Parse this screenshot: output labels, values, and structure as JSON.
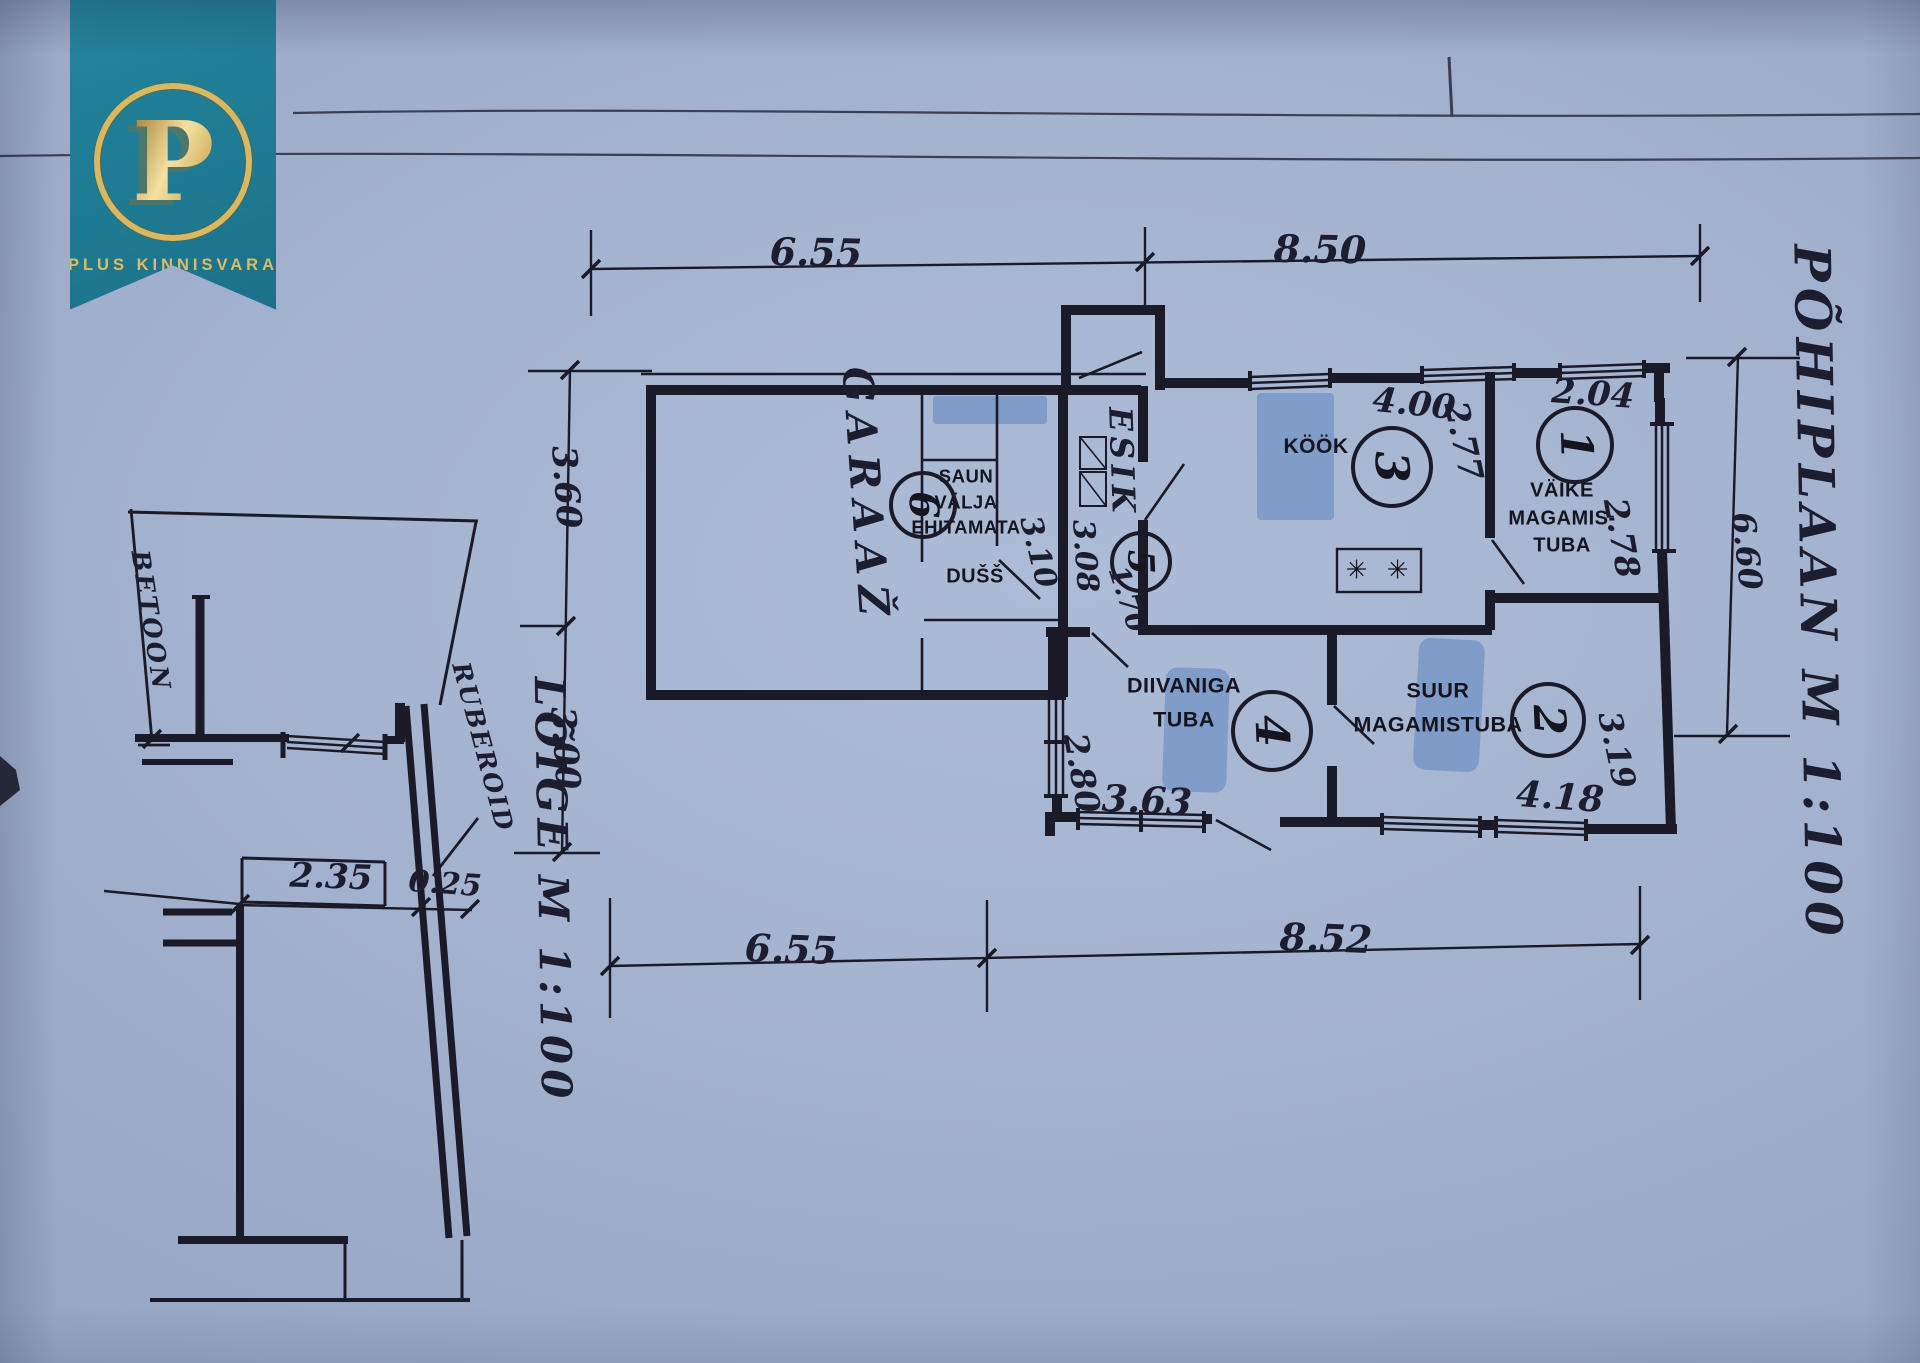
{
  "brand": {
    "name": "PLUS KINNISVARA",
    "monogram": "P",
    "banner_color": "#1e7a92",
    "gold_color": "#d8b860"
  },
  "plan": {
    "title": "PÕHIPLAAN M 1:100",
    "rooms": {
      "garage": "GARAAŽ",
      "hall": "ESIK",
      "kitchen": "KÖÖK",
      "shower": "DUŠŠ",
      "sauna_line1": "SAUN",
      "sauna_line2": "VÄLJA",
      "sauna_line3": "EHITAMATA",
      "small_bedroom_line1": "VÄIKE",
      "small_bedroom_line2": "MAGAMIS-",
      "small_bedroom_line3": "TUBA",
      "living_line1": "DIIVANIGA",
      "living_line2": "TUBA",
      "big_bedroom_line1": "SUUR",
      "big_bedroom_line2": "MAGAMISTUBA"
    },
    "room_numbers": {
      "r1": "1",
      "r2": "2",
      "r3": "3",
      "r4": "4",
      "r5": "5",
      "r6": "6"
    },
    "dims": {
      "top_left": "6.55",
      "top_right": "8.50",
      "bottom_left": "6.55",
      "bottom_right": "8.52",
      "left_upper": "3.60",
      "left_lower": "3.00",
      "right_side": "6.60",
      "hall_a": "3.10",
      "hall_b": "3.08",
      "hall_c": "1.70",
      "kitchen_w": "4.00",
      "kitchen_h": "2.77",
      "bed1_w": "2.04",
      "bed1_h": "2.78",
      "living_h": "2.80",
      "living_w": "3.63",
      "bed2_h": "3.19",
      "bed2_w": "4.18"
    },
    "stove_symbol": "✳ ✳"
  },
  "section": {
    "title": "LÕIGE M 1:100",
    "material_concrete": "BETOON",
    "material_roof": "RUBEROID",
    "dim_width": "2.35",
    "dim_wall": "0.25"
  }
}
